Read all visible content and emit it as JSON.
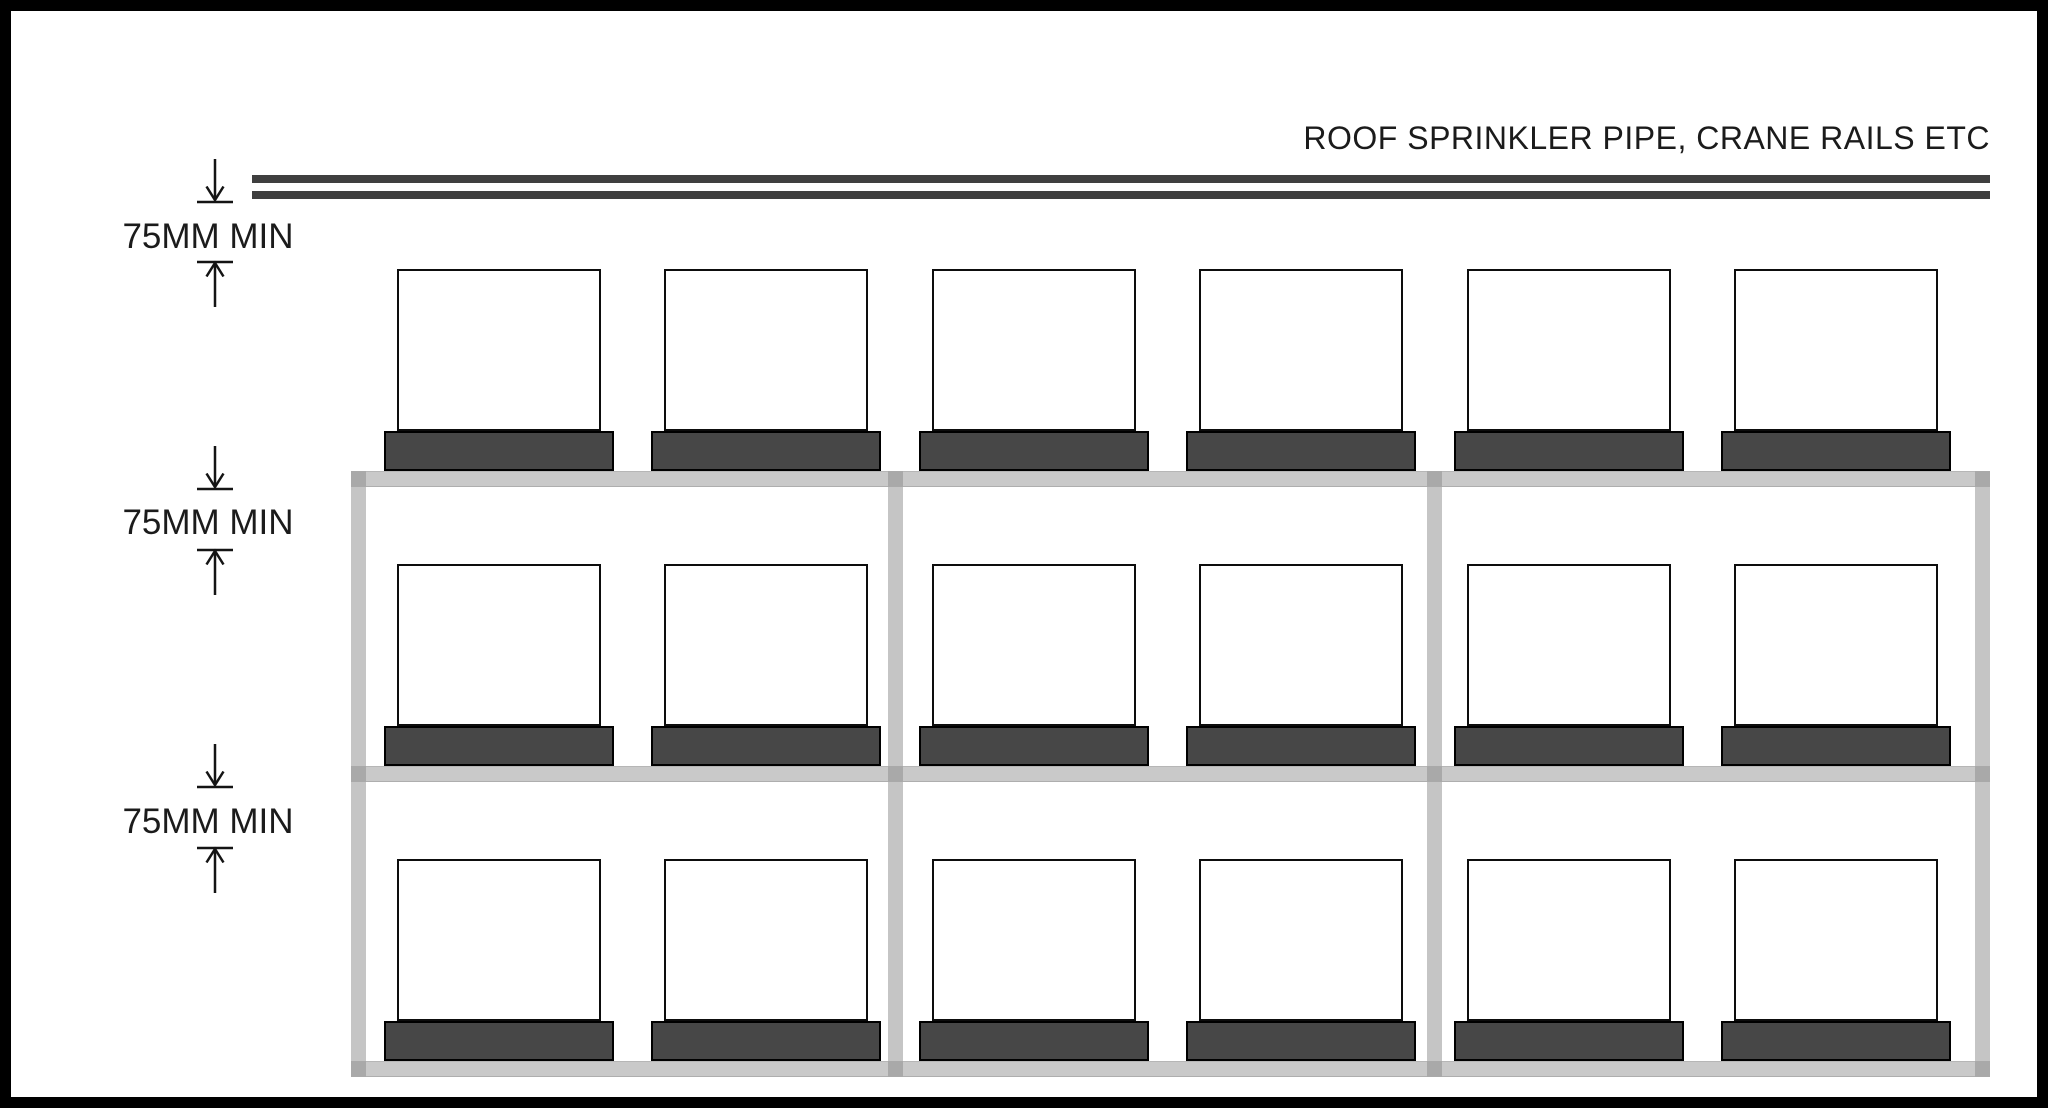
{
  "title": "ROOF SPRINKLER PIPE, CRANE RAILS ETC",
  "dimensions": [
    {
      "label": "75MM MIN"
    },
    {
      "label": "75MM MIN"
    },
    {
      "label": "75MM MIN"
    }
  ],
  "rack": {
    "bays": 3,
    "levels": 3,
    "pallets_per_bay": 2,
    "uprights": 4,
    "roof_lines": 2
  },
  "colors": {
    "frame": "#000000",
    "background": "#ffffff",
    "line_dark": "#3f3f3f",
    "pallet_base": "#474747",
    "beam": "#c9c9c9",
    "upright": "#c5c5c5",
    "junction": "#a9a9a9",
    "outline": "#0d0d0d",
    "text": "#1b1b1b"
  }
}
